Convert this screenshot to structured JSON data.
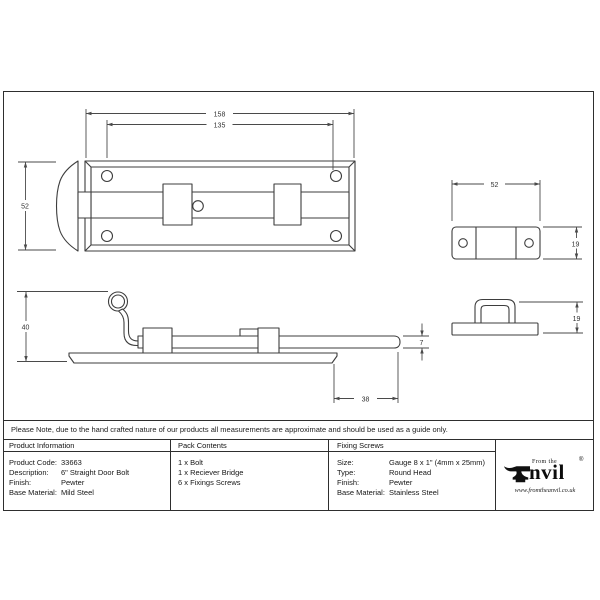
{
  "note": "Please Note, due to the hand crafted nature of our products all measurements are approximate and should be used as a guide only.",
  "table": {
    "product_information": {
      "header": "Product Information",
      "rows": [
        {
          "label": "Product Code:",
          "value": "33663"
        },
        {
          "label": "Description:",
          "value": "6\" Straight Door Bolt"
        },
        {
          "label": "Finish:",
          "value": "Pewter"
        },
        {
          "label": "Base Material:",
          "value": "Mild Steel"
        }
      ]
    },
    "pack_contents": {
      "header": "Pack Contents",
      "items": [
        "1 x Bolt",
        "1 x Reciever Bridge",
        "6 x Fixings Screws"
      ]
    },
    "fixing_screws": {
      "header": "Fixing Screws",
      "rows": [
        {
          "label": "Size:",
          "value": "Gauge 8 x 1\" (4mm x 25mm)"
        },
        {
          "label": "Type:",
          "value": "Round Head"
        },
        {
          "label": "Finish:",
          "value": "Pewter"
        },
        {
          "label": "Base Material:",
          "value": "Stainless Steel"
        }
      ]
    }
  },
  "logo": {
    "from_the": "From the",
    "name_rest": "nvil",
    "registered": "®",
    "url": "www.fromtheanvil.co.uk"
  },
  "drawing": {
    "dims": {
      "plate_length": "158",
      "hole_spacing": "135",
      "plate_width": "52",
      "overall_height": "40",
      "bolt_thickness": "7",
      "bolt_throw": "38",
      "keep_width": "52",
      "keep_depth": "19",
      "keep_height": "19"
    }
  },
  "colors": {
    "drawing_line": "#3d3d3d",
    "dimension_line": "#4a4a4a",
    "border": "#2e2e2e",
    "text": "#1a1a1a"
  }
}
